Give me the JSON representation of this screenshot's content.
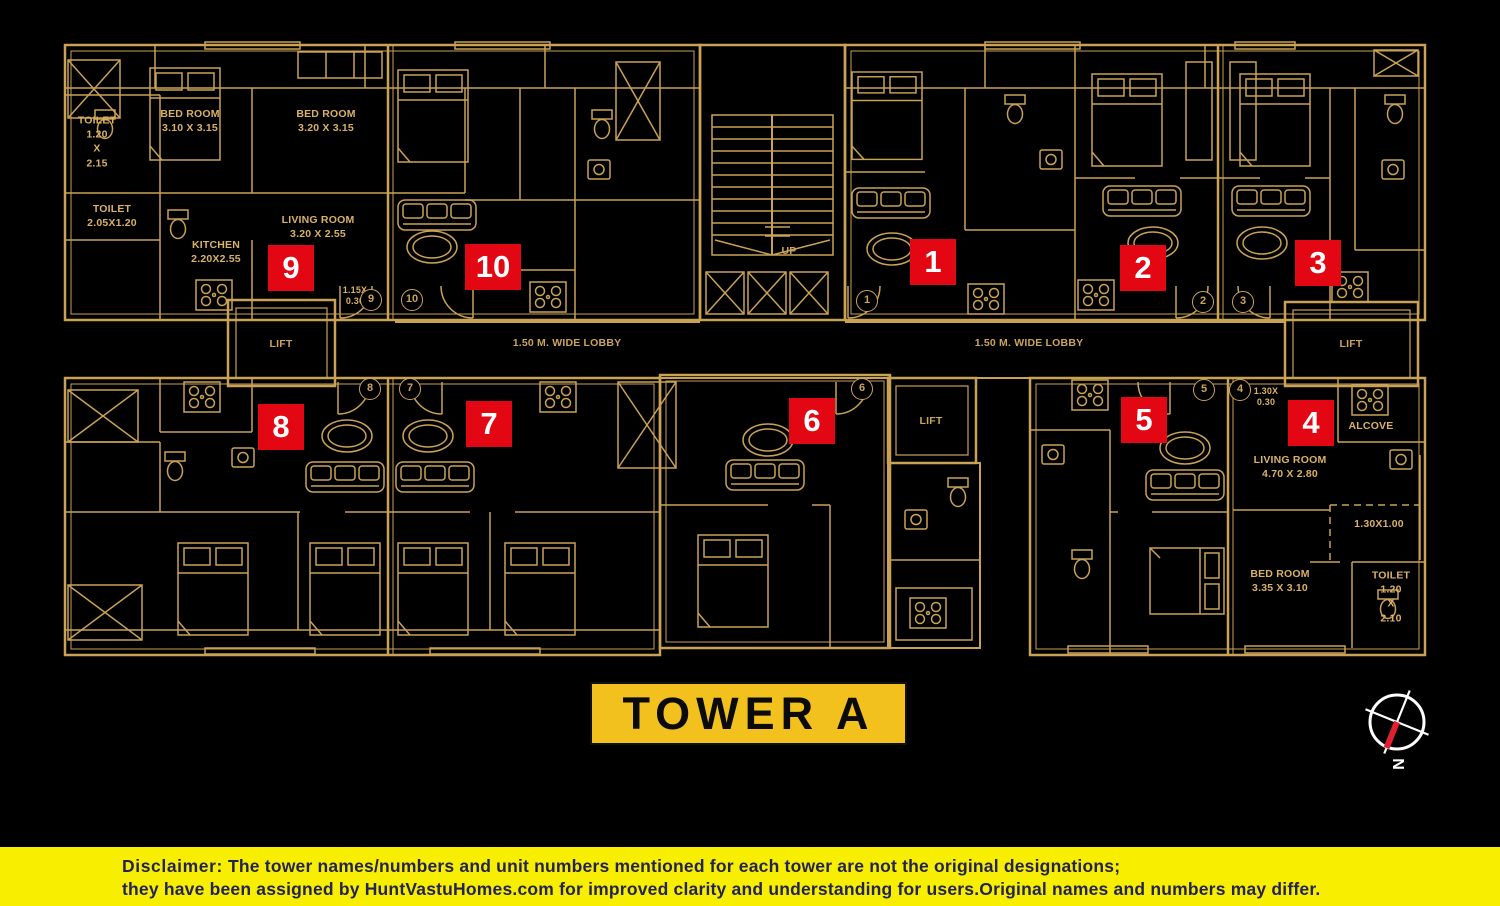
{
  "colors": {
    "background": "#000000",
    "plan_line": "#C9A255",
    "plan_text": "#D9B266",
    "badge_red": "#E30613",
    "badge_text": "#FFFFFF",
    "banner_yellow": "#F2C11E",
    "disclaimer_yellow": "#F8EF00",
    "disclaimer_text": "#23235A",
    "compass_needle_red": "#E02030"
  },
  "tower_banner": {
    "label": "TOWER A"
  },
  "compass": {
    "north_label": "N"
  },
  "lobby": {
    "left": "1.50 M. WIDE LOBBY",
    "right": "1.50 M. WIDE LOBBY"
  },
  "lifts": {
    "left": "LIFT",
    "center": "LIFT",
    "right": "LIFT"
  },
  "stairs": {
    "up": "UP"
  },
  "badges": {
    "b1": "1",
    "b2": "2",
    "b3": "3",
    "b4": "4",
    "b5": "5",
    "b6": "6",
    "b7": "7",
    "b8": "8",
    "b9": "9",
    "b10": "10"
  },
  "door_markers": {
    "m1": "1",
    "m2": "2",
    "m3": "3",
    "m4": "4",
    "m5": "5",
    "m6": "6",
    "m7": "7",
    "m8": "8",
    "m9": "9",
    "m10": "10"
  },
  "room_labels": {
    "toilet_unit9_top": "TOILET\n1.20\nX\n2.15",
    "bedroom_unit9_left": "BED ROOM\n3.10 X 3.15",
    "bedroom_unit9_right": "BED ROOM\n3.20 X 3.15",
    "toilet_unit9_small": "TOILET\n2.05X1.20",
    "kitchen_unit9": "KITCHEN\n2.20X2.55",
    "living_unit9": "LIVING ROOM\n3.20 X 2.55",
    "dim_unit9_door": "1.15X\n0.30",
    "dim_unit4_door": "1.30X\n0.30",
    "alcove_unit4": "ALCOVE",
    "living_unit4": "LIVING ROOM\n4.70 X 2.80",
    "dim_unit4_passage": "1.30X1.00",
    "bedroom_unit4": "BED ROOM\n3.35 X 3.10",
    "toilet_unit4": "TOILET\n1.20\nX\n2.10"
  },
  "disclaimer": {
    "label": "Disclaimer:",
    "line1": " The tower names/numbers and unit numbers mentioned for each tower are not the original designations;",
    "line2": "they have been assigned by HuntVastuHomes.com for improved clarity and understanding for users.Original names and numbers may differ."
  }
}
